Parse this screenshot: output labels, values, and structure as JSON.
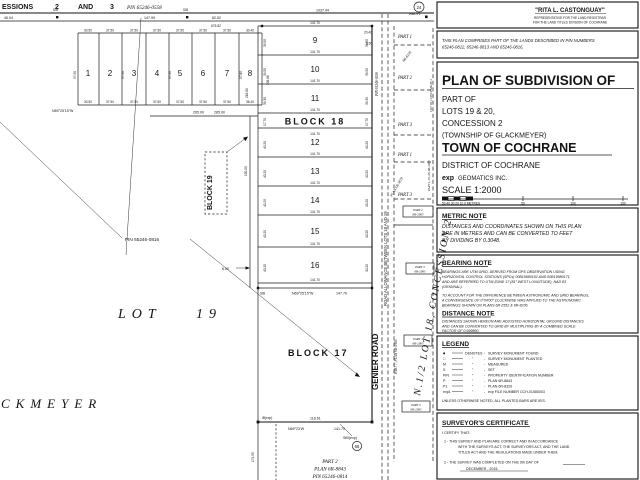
{
  "plan": {
    "top": {
      "c1": "ESSIONS",
      "c2": "2",
      "c3": "AND",
      "c4": "3",
      "pin": "PIN 65246-0558",
      "d46": "46.04",
      "d147": "147.99",
      "d82": "82.52",
      "d1037": "1037.44",
      "d141": "141.70",
      "sib": "SIB"
    },
    "small": {
      "numbers": [
        "1",
        "2",
        "3",
        "4",
        "5",
        "6",
        "7",
        "8"
      ],
      "wt": [
        "30.50",
        "37.50",
        "37.50",
        "37.50",
        "37.50",
        "37.50",
        "37.50",
        "30.40"
      ],
      "wb": [
        "30.50",
        "37.50",
        "37.50",
        "37.50",
        "37.50",
        "37.50",
        "37.50",
        "36.40"
      ],
      "total": "675.82",
      "side": "97.90",
      "side8": "97.80",
      "brg": "N69°25'15\"W",
      "d265": "265.00",
      "d285": "285.00",
      "d216": "216.80",
      "d336": "336.66"
    },
    "col": {
      "rows": [
        {
          "n": "9",
          "len": "141.70",
          "side": "39.50"
        },
        {
          "n": "10",
          "len": "141.70",
          "side": "39.50"
        },
        {
          "n": "11",
          "len": "141.70",
          "side": "39.30"
        },
        {
          "n": "12",
          "len": "141.70",
          "side": "40.20"
        },
        {
          "n": "13",
          "len": "141.70",
          "side": "40.20"
        },
        {
          "n": "14",
          "len": "141.70",
          "side": "40.20"
        },
        {
          "n": "15",
          "len": "141.70",
          "side": "40.20"
        },
        {
          "n": "16",
          "len": "141.70",
          "side": "40.20"
        }
      ],
      "b18": "BLOCK 18",
      "b18side": "17.70",
      "b18len": "141.70",
      "botbrg": "N69°25'15\"W",
      "botlen": "147.70",
      "sib": "SIB",
      "d150": "150.00",
      "d2040": "20.40",
      "d650": "6.50",
      "d600": "6.00"
    },
    "b19": "BLOCK 19",
    "pin0816": "PIN 65246-0816",
    "lot19a": "LOT",
    "lot19b": "19",
    "glk": "CKMEYER",
    "b17": {
      "label": "BLOCK 17",
      "d118": "118.61",
      "d141": "141.70",
      "brg": "N69°23'W",
      "d174": "174.55",
      "sibexp": "SIB(exp)",
      "ibexp": "IB(exp)",
      "c66": "66"
    },
    "p2s": {
      "l1": "PART 2",
      "l2": "PLAN 6R-8843",
      "l3": "PIN 65246-0814"
    },
    "gen": {
      "road": "GENIER ROAD",
      "allow": "ROAD ALLOWANCE BETWEEN LOTS 18 AND 19",
      "part7": "PART 7, PLAN 6R-2985",
      "pin": "PIN 65246-0556"
    },
    "east": {
      "p1a": "PART 1",
      "p2": "PART 2",
      "p3a": "PART 3",
      "p1b": "PART 1",
      "p3b": "PART 3",
      "dg1": "6R-8236",
      "dg2": "PLAN 6R-3829",
      "lot18": "LOT 18, CONCESSION 2",
      "p1plan": "PART 1, PLAN 6R-2985",
      "half": "N.1/2  LOT 18,  CONCESSION 2",
      "c24": "24",
      "wb": "WBOY1",
      "boxes": [
        {
          "a": "PART 2",
          "b": "6R-2985"
        },
        {
          "a": "PART 3",
          "b": "6R-2985"
        },
        {
          "a": "PART 4",
          "b": "6R-2985"
        },
        {
          "a": "PART 5",
          "b": "6R-2985"
        }
      ]
    }
  },
  "titleblock": {
    "registrar": {
      "name": "\"RITA L. CASTONGUAY\"",
      "line1": "REPRESENTATIVE FOR THE LAND REGISTRAR",
      "line2": "FOR THE LAND TITLES DIVISION OF COCHRANE"
    },
    "comprises": {
      "line1": "THIS PLAN COMPRISES PART OF THE LANDS DESCRIBED IN PIN NUMBERS",
      "line2": "65246-0812, 65246-0813 AND 65246-0816."
    },
    "title": {
      "main": "PLAN OF SUBDIVISION OF",
      "part_of": "PART OF",
      "lots": "LOTS 19 & 20,",
      "concession": "CONCESSION 2",
      "township": "(TOWNSHIP OF GLACKMEYER)",
      "town": "TOWN OF COCHRANE",
      "district": "DISTRICT OF COCHRANE",
      "firm_exp": "exp",
      "firm": "GEOMATICS INC.",
      "scale": "SCALE   1:2000",
      "bar_left": "50 40 30 20 10 0  METRES",
      "bar_50": "50",
      "bar_100": "100",
      "bar_150": "150"
    },
    "metric": {
      "h": "METRIC NOTE",
      "l1": "DISTANCES AND COORDINATES SHOWN ON THIS PLAN",
      "l2": "ARE IN METRES AND CAN BE CONVERTED TO FEET",
      "l3": "BY DIVIDING BY 0.3048."
    },
    "bearing": {
      "h": "BEARING NOTE",
      "l1": "BEARINGS ARE UTM GRID, DERIVED FROM GPS OBSERVATION USING",
      "l2": "HORIZONTAL CONTROL STATIONS (SPCs) 00B19980152 AND 00B19980171,",
      "l3": "AND ARE REFERRED TO UTM ZONE 17 (81° WEST LONGITUDE), NAD 83",
      "l4": "(ORIGINAL).",
      "l5": "TO ACCOUNT FOR THE DIFFERENCE BETWEEN ASTRONOMIC AND GRID BEARINGS,",
      "l6": "A CONVERGENCE OF 0°04'00\" CLOCKWISE WAS APPLIED TO THE ASTRONOMIC",
      "l7": "BEARINGS SHOWN ON PLANS 6R-2552 & 6R-8236."
    },
    "distance": {
      "h": "DISTANCE NOTE",
      "l1": "DISTANCES SHOWN HEREON ARE ADJUSTED HORIZONTAL GROUND DISTANCES",
      "l2": "AND CAN BE CONVERTED TO GRID BY MULTIPLYING BY A COMBINED SCALE",
      "l3": "FACTOR OF 0.999860."
    },
    "legend": {
      "h": "LEGEND",
      "denotes": "DENOTES",
      "ditto": "\"",
      "rows": [
        {
          "sym": "■",
          "label": "SURVEY MONUMENT FOUND"
        },
        {
          "sym": "□",
          "label": "SURVEY MONUMENT PLANTED"
        },
        {
          "sym": "M",
          "label": "MEASURED"
        },
        {
          "sym": "S",
          "label": "SET"
        },
        {
          "sym": "PIN",
          "label": "PROPERTY IDENTIFICATION NUMBER"
        },
        {
          "sym": "P",
          "label": "PLAN 6R-8843"
        },
        {
          "sym": "P1",
          "label": "PLAN 6R-8320"
        },
        {
          "sym": "exp1",
          "label": "exp FILE NUMBER CCH-01585003"
        }
      ],
      "note": "UNLESS OTHERWISE NOTED, ALL PLANTED BARS ARE IB'S."
    },
    "certificate": {
      "h": "SURVEYOR'S CERTIFICATE",
      "intro": "I CERTIFY THAT:",
      "i1a": "1  -   THIS SURVEY AND PLAN ARE CORRECT AND IN ACCORDANCE",
      "i1b": "WITH THE SURVEYS ACT, THE SURVEYORS ACT, AND THE LAND",
      "i1c": "TITLES ACT AND THE REGULATIONS MADE UNDER THEM.",
      "i2a": "2  -   THE SURVEY WAS COMPLETED ON THE     9th     DAY OF",
      "i2b": "DECEMBER          , 2015."
    }
  }
}
